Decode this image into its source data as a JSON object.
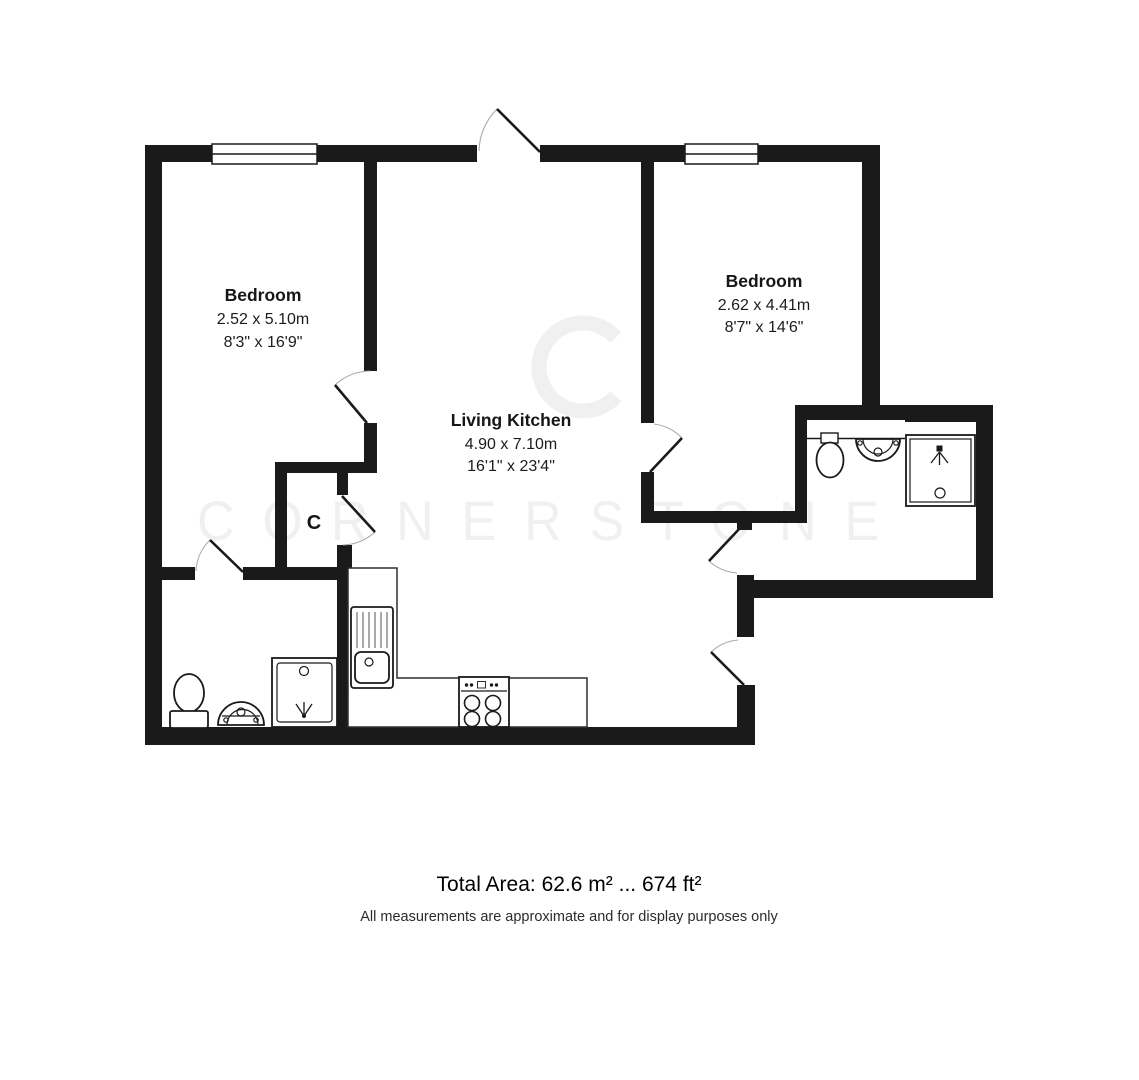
{
  "floorplan": {
    "rooms": [
      {
        "name": "Bedroom",
        "metric": "2.52 x 5.10m",
        "imperial": "8'3\" x 16'9\""
      },
      {
        "name": "Living Kitchen",
        "metric": "4.90 x 7.10m",
        "imperial": "16'1\" x 23'4\""
      },
      {
        "name": "Bedroom",
        "metric": "2.62 x 4.41m",
        "imperial": "8'7\" x 14'6\""
      }
    ],
    "closet_label": "C",
    "watermark": {
      "logo_letter": "C",
      "brand_text": "CORNERSTONE"
    }
  },
  "footer": {
    "total_area": "Total Area: 62.6 m² ... 674 ft²",
    "disclaimer": "All measurements are approximate and for display purposes only"
  },
  "colors": {
    "wall": "#1a1a1a",
    "background": "#ffffff",
    "watermark": "#f0f0f0",
    "fixture_stroke": "#1a1a1a"
  }
}
